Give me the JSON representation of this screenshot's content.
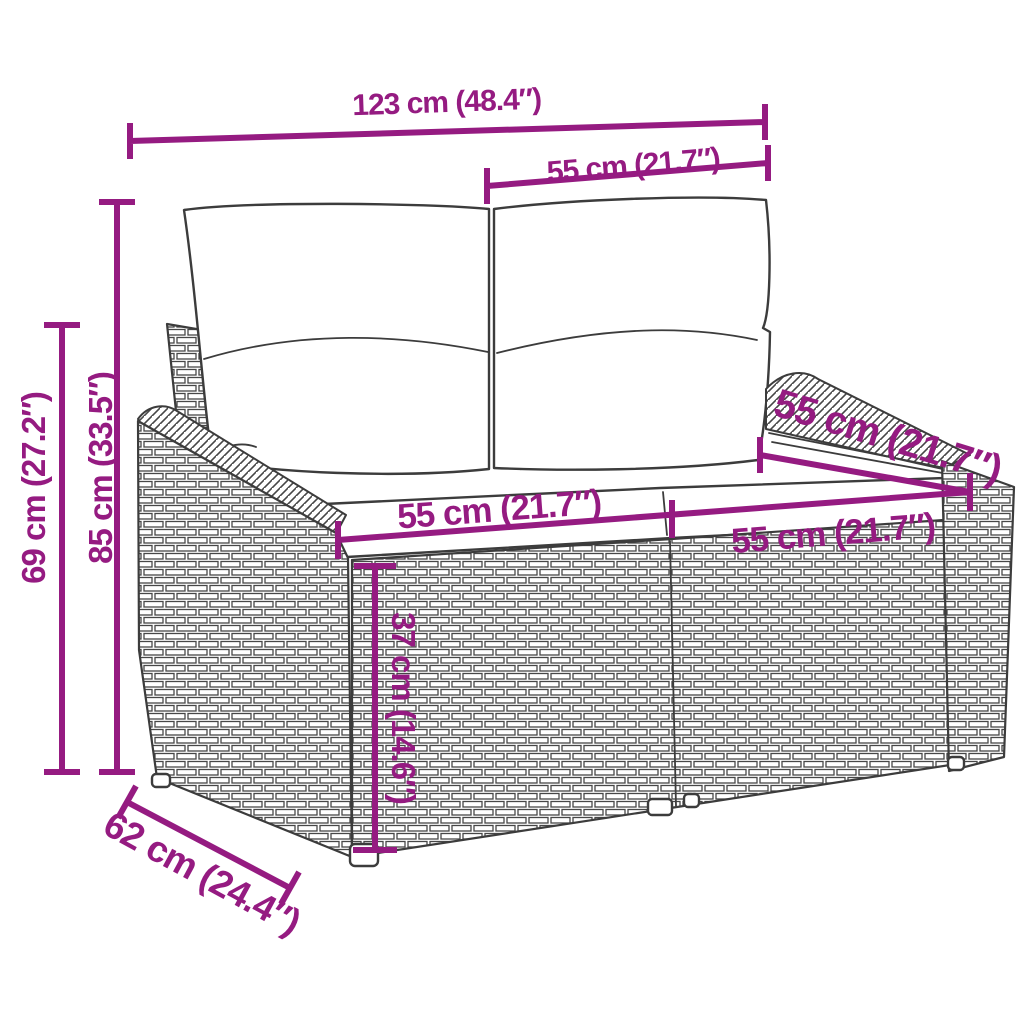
{
  "diagram": {
    "accent_color": "#951b81",
    "art_color": "#3c3c3c",
    "background_color": "#ffffff",
    "subject": "rattan 2-seater garden sofa with cushions, line-art dimension drawing",
    "labels": {
      "width_total": "123 cm (48.4″)",
      "width_backrest": "55 cm (21.7″)",
      "height_total": "85 cm (33.5″)",
      "height_armrest": "69 cm (27.2″)",
      "seat_width_left": "55 cm (21.7″)",
      "seat_width_right": "55 cm (21.7″)",
      "depth_seat": "55 cm (21.7″)",
      "seat_height": "37 cm (14.6″)",
      "depth_total": "62 cm (24.4″)"
    }
  }
}
